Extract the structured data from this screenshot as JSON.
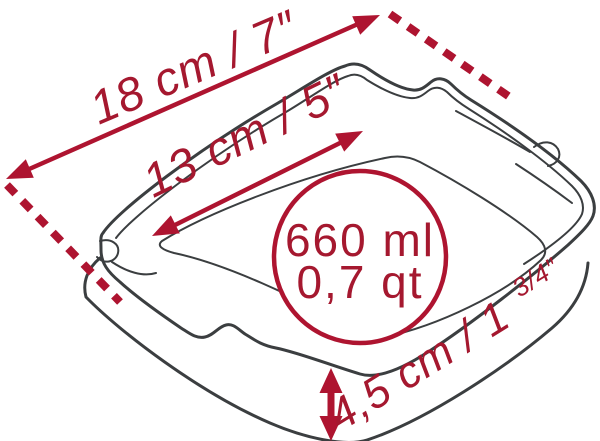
{
  "diagram": {
    "title": "Square baking dish dimension diagram",
    "measurements": {
      "outer_width": "18 cm / 7″",
      "inner_width": "13 cm / 5″",
      "height": "4,5 cm / 1",
      "height_fraction": "3/4″",
      "capacity_ml": "660 ml",
      "capacity_qt": "0,7 qt"
    },
    "colors": {
      "accent_red": "#AE1430",
      "text_red": "#A5182F",
      "line_gray": "#3B3E40",
      "background": "#FFFFFF"
    }
  }
}
